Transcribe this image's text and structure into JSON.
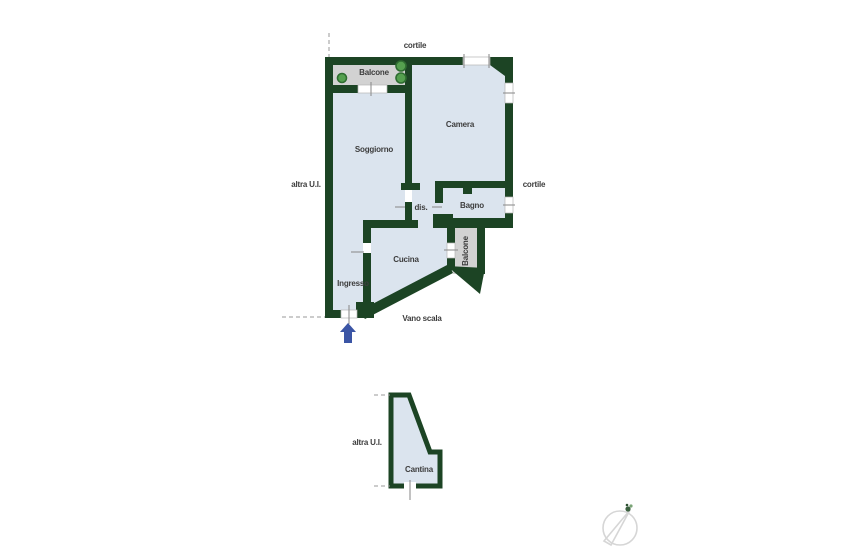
{
  "colors": {
    "wall": "#1c4424",
    "floor": "#dbe4ee",
    "balcony": "#d2d2d2",
    "plant": "#55a04f",
    "arrow": "#3b55a5",
    "label": "#3d3d3d",
    "compass": "#d6d6d6"
  },
  "main_plan": {
    "labels": {
      "cortile_top": "cortile",
      "balcone_top": "Balcone",
      "camera": "Camera",
      "soggiorno": "Soggiorno",
      "altra_ui": "altra U.I.",
      "cortile_right": "cortile",
      "dis": "dis.",
      "bagno": "Bagno",
      "cucina": "Cucina",
      "balcone_right": "Balcone",
      "ingresso": "Ingresso",
      "vano_scala": "Vano scala"
    }
  },
  "cellar_plan": {
    "labels": {
      "altra_ui": "altra U.I.",
      "cantina": "Cantina"
    }
  },
  "icons": {
    "entrance_arrow": "entrance-arrow",
    "compass": "compass-north-needle",
    "plants": "balcony-plant"
  }
}
